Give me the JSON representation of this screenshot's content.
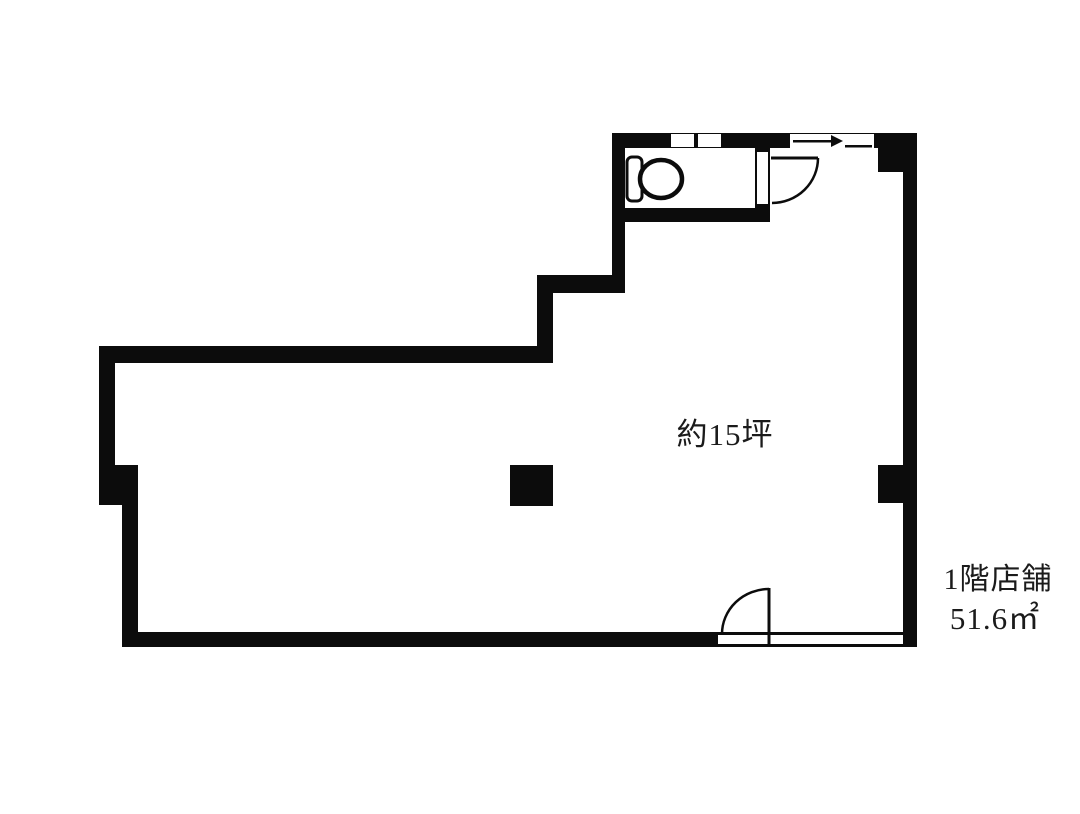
{
  "floorplan": {
    "area_label": "約15坪",
    "unit_label": {
      "floor": "1階店舗",
      "size": "51.6㎡"
    },
    "colors": {
      "wall": "#0c0c0c",
      "background": "#ffffff",
      "text": "#1b1b1b",
      "fixture_fill": "#ffffff"
    },
    "icons": {
      "toilet": "toilet-icon",
      "toilet_door": "door-swing-icon",
      "entrance_door": "door-swing-icon",
      "window_small": "window-icon",
      "window_sliding": "sliding-window-icon",
      "column": "pillar"
    }
  }
}
